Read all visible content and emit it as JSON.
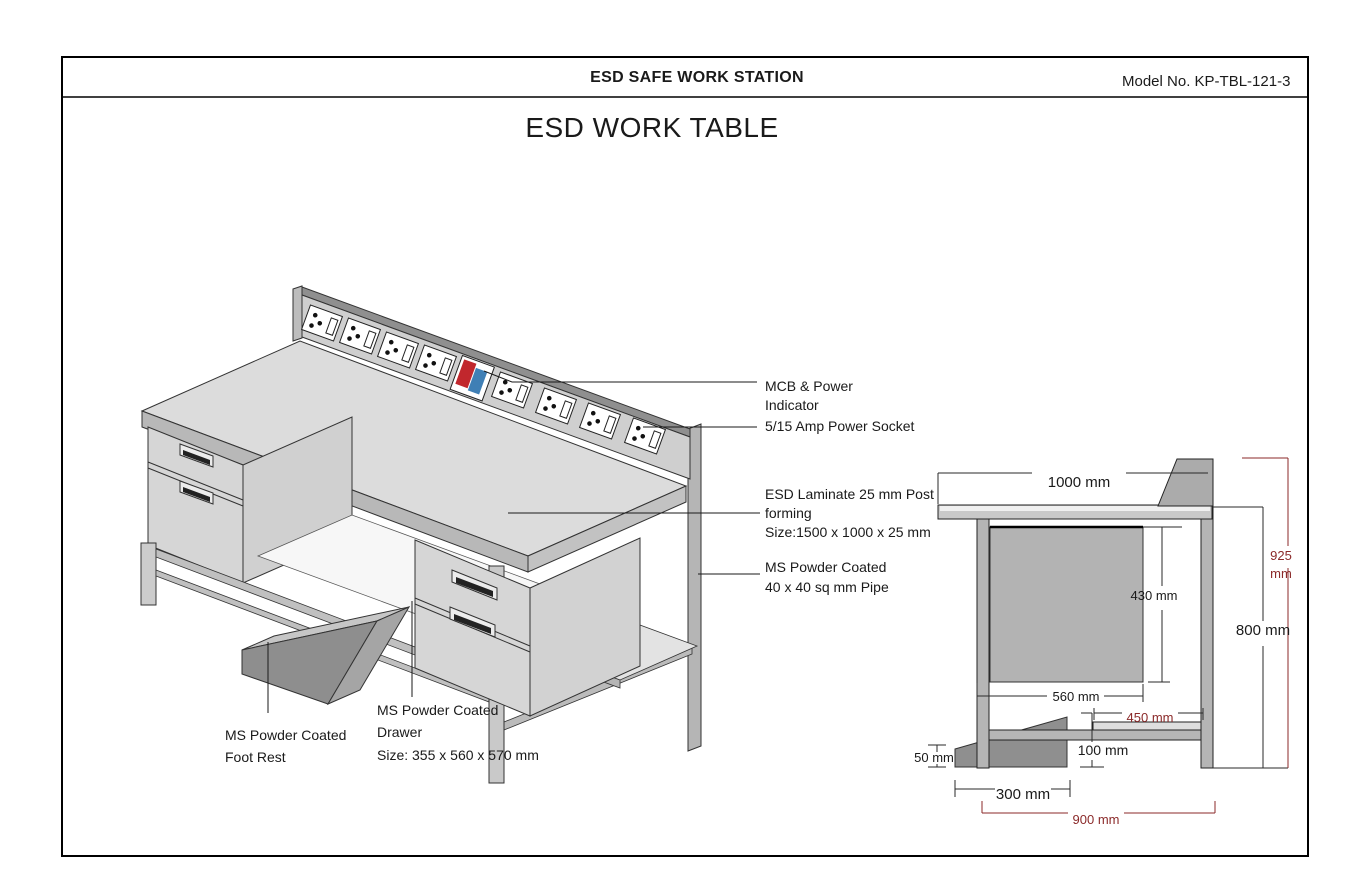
{
  "header": {
    "station_title": "ESD SAFE WORK STATION",
    "model_no": "Model No. KP-TBL-121-3"
  },
  "title": "ESD WORK TABLE",
  "callouts": {
    "mcb_line1": "MCB & Power",
    "mcb_line2": "Indicator",
    "socket": "5/15 Amp Power Socket",
    "laminate_line1": "ESD Laminate 25 mm Post",
    "laminate_line2": "forming",
    "laminate_line3": "Size:1500 x 1000 x 25 mm",
    "pipe_line1": "MS Powder Coated",
    "pipe_line2": "40 x 40 sq mm Pipe",
    "footrest_line1": "MS Powder Coated",
    "footrest_line2": "Foot Rest",
    "drawer_line1": "MS Powder Coated",
    "drawer_line2": "Drawer",
    "drawer_line3": "Size: 355 x 560 x 570 mm"
  },
  "side_view": {
    "top_depth": "1000 mm",
    "overall_height_value": "925",
    "overall_height_unit": "mm",
    "table_height": "800 mm",
    "drawer_height": "430 mm",
    "drawer_depth": "560 mm",
    "shelf_depth": "450 mm",
    "shelf_height": "100 mm",
    "footrest_height": "50 mm",
    "footrest_depth": "300 mm",
    "base_depth": "900 mm"
  },
  "colors": {
    "dim_red": "#8b2a2a",
    "mcb_red": "#c1272d",
    "mcb_blue": "#3f7fb5"
  }
}
